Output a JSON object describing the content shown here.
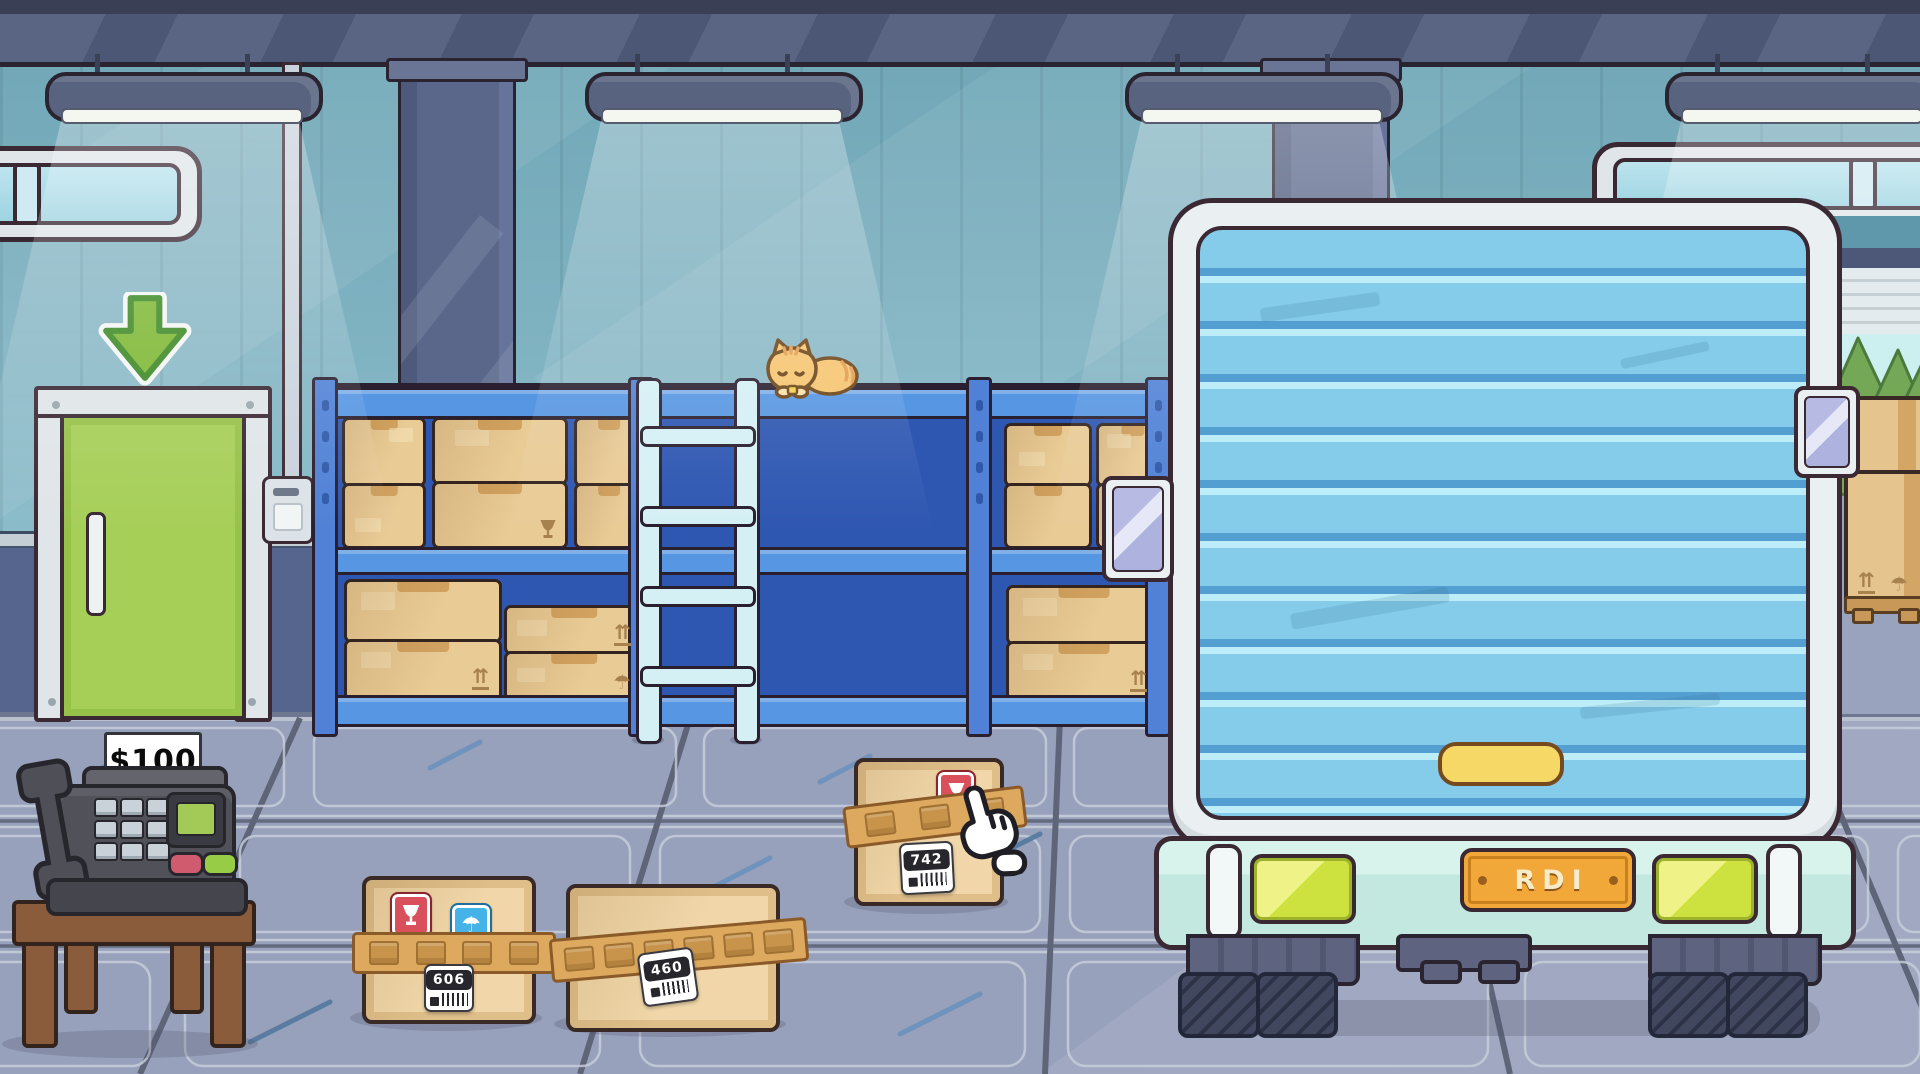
{
  "scene": {
    "name": "warehouse loading dock"
  },
  "labels": {
    "price": "$100",
    "plate": "RDI"
  },
  "floor_boxes": [
    {
      "label": "606",
      "stickers": [
        "fragile",
        "keep-dry"
      ]
    },
    {
      "label": "460",
      "stickers": []
    },
    {
      "label": "742",
      "stickers": [
        "fragile"
      ]
    }
  ],
  "icons": {
    "side_up_glyph": "⇈",
    "keep_dry_glyph": "☂",
    "exit_arrow": "down-arrow",
    "fragile": "broken-goblet",
    "cursor": "glove-pointer",
    "cat": "sleeping-cat"
  },
  "colors": {
    "wall_upper": "#76AEBE",
    "wall_lower": "#56658E",
    "floor": "#97A1BB",
    "shelf_frame": "#5796E2",
    "shelf_panel": "#2E57B2",
    "door_green": "#A6CF58",
    "truck_roller_door": "#85CBEA",
    "bumper": "#C2E8E0",
    "plate": "#F2A838",
    "tail_light": "#CEE23F",
    "crate": "#E9CB96",
    "label_red": "#D94F5C",
    "label_blue": "#45B2E8",
    "ladder": "#D5F0F5",
    "cat": "#F6C570"
  }
}
